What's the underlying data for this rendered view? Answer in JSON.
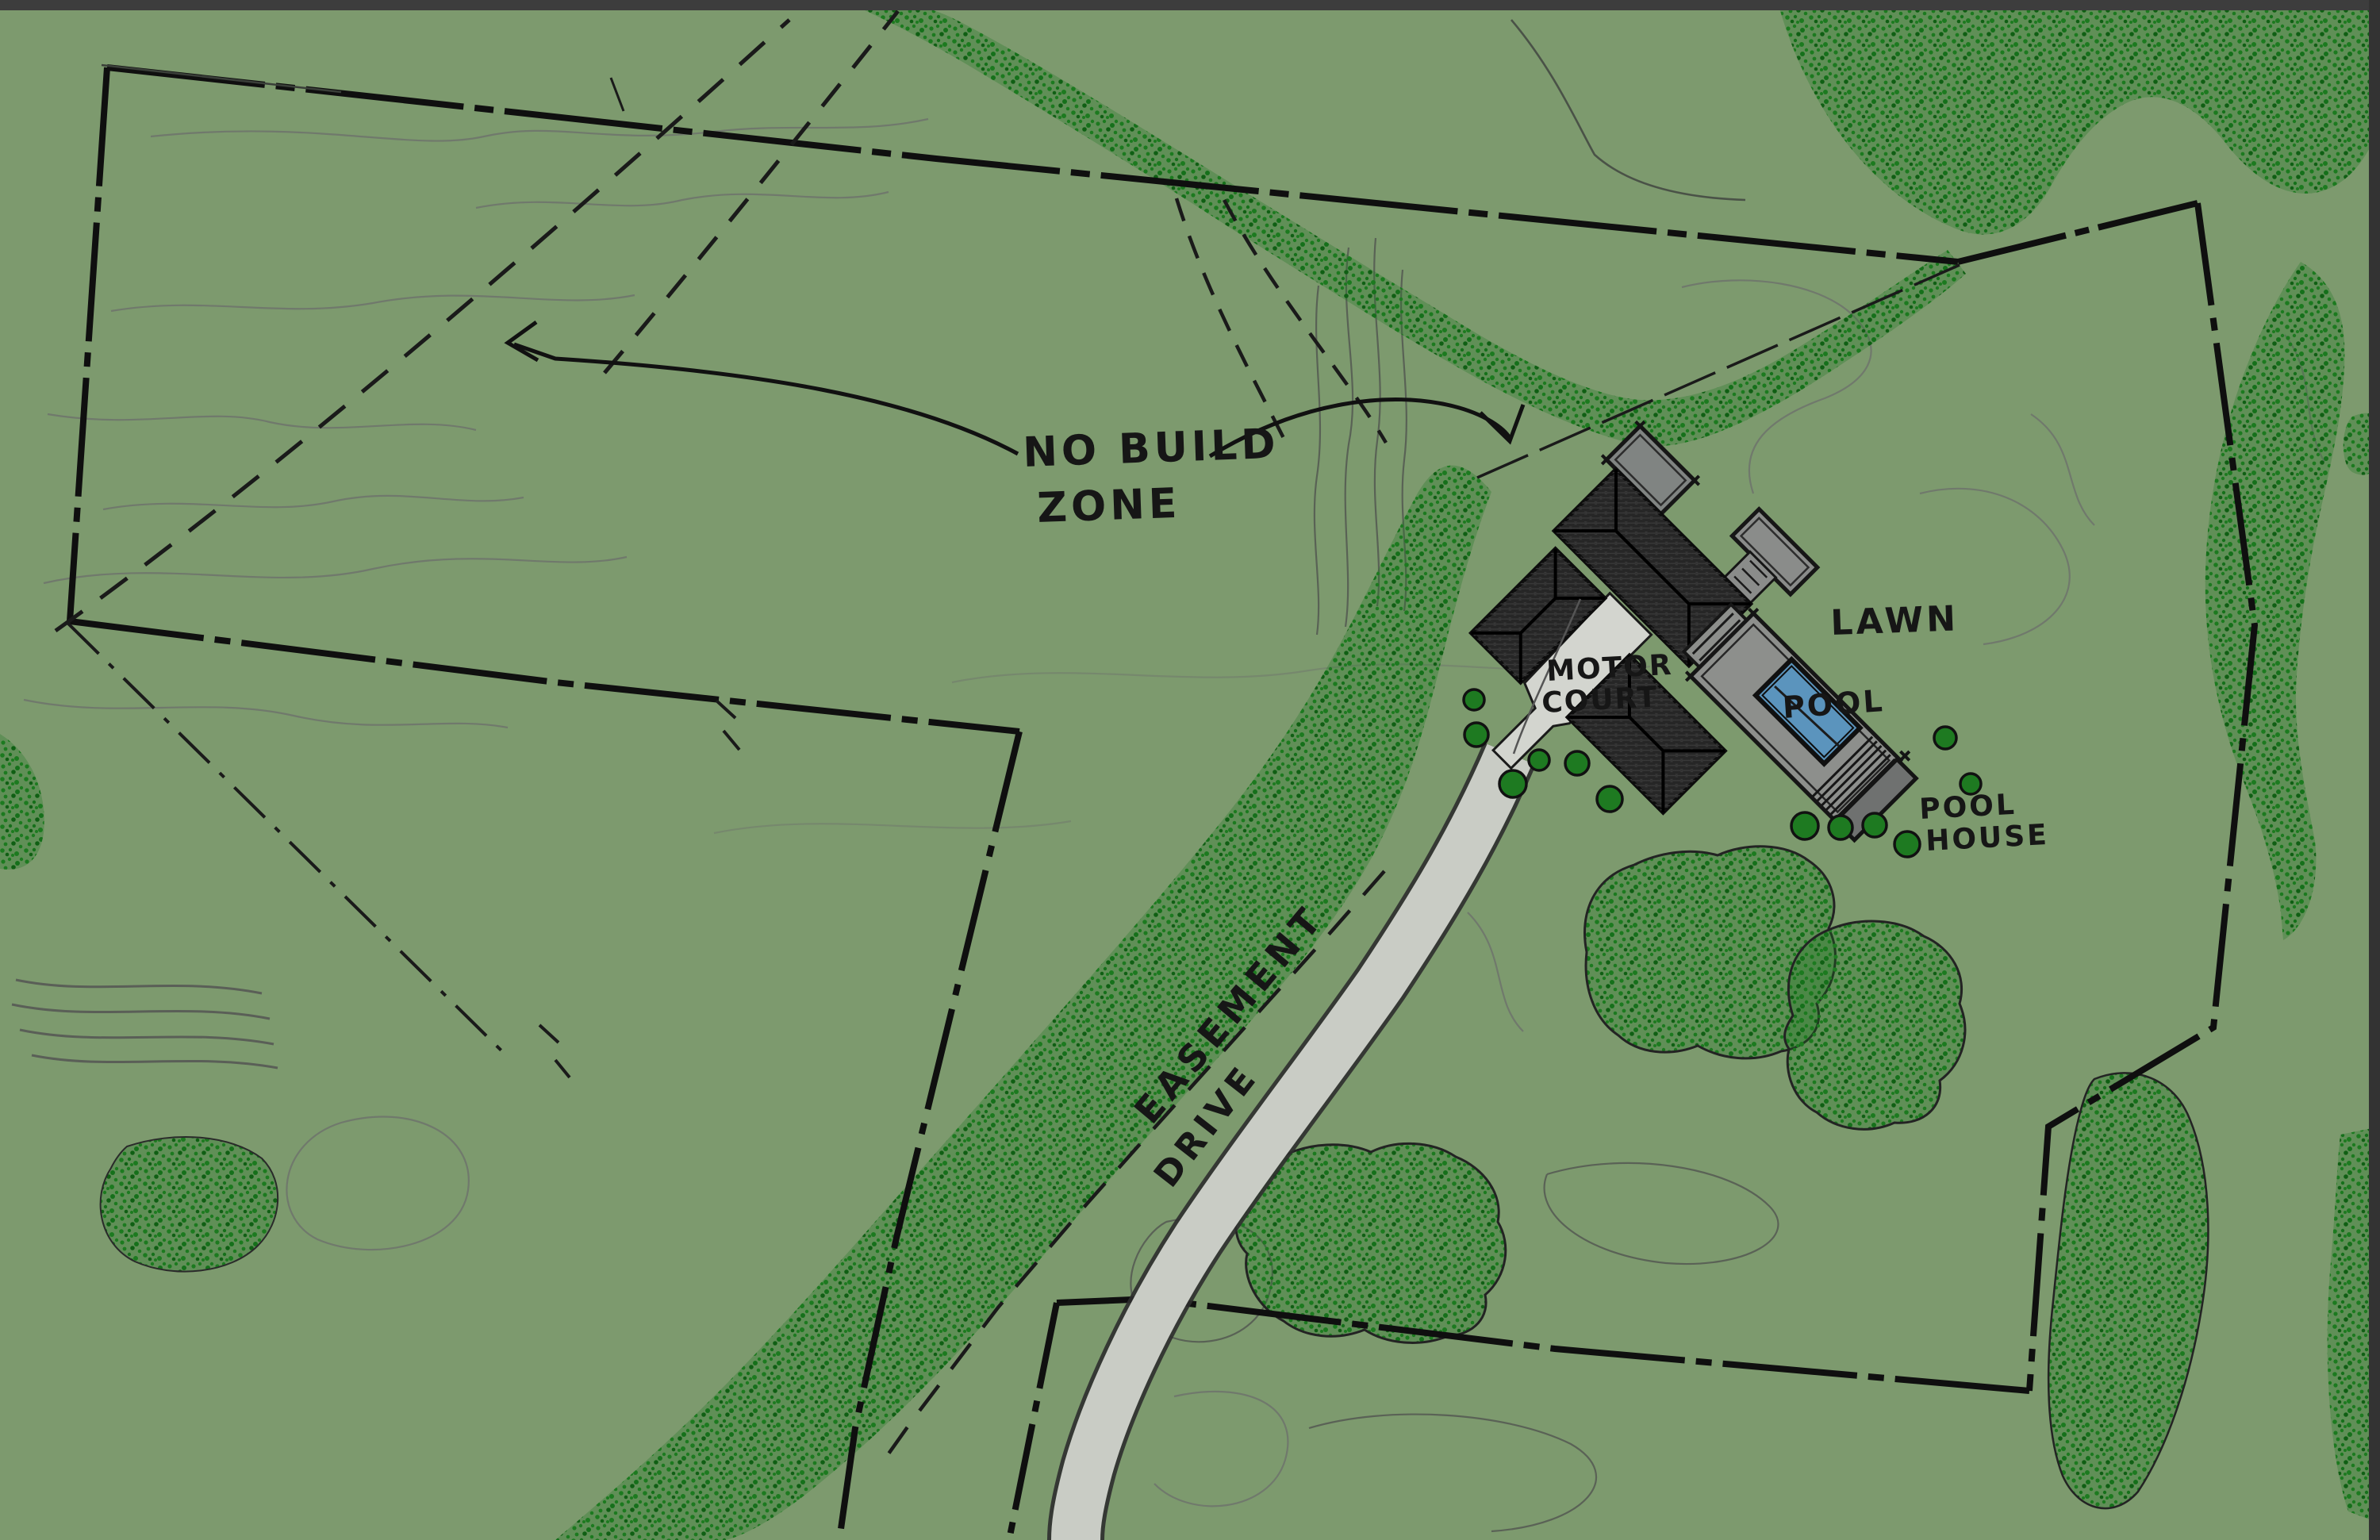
{
  "plan": {
    "type": "hand-drawn residential site plan sketch",
    "labels": {
      "no_build_line1": "NO BUILD",
      "no_build_line2": "ZONE",
      "motor_court_line1": "MOTOR",
      "motor_court_line2": "COURT",
      "lawn": "LAWN",
      "pool": "POOL",
      "pool_house_line1": "POOL",
      "pool_house_line2": "HOUSE",
      "easement": "EASEMENT",
      "drive": "DRIVE"
    },
    "colors": {
      "background": "#7d9a6e",
      "vegetation": "#1c7a1f",
      "vegetation_dark": "#0f5f13",
      "contour": "#6f766c",
      "ink": "#141414",
      "drive": "#c9ccc5",
      "motor_court": "#d3d5cf",
      "deck_gray": "#8d8f8c",
      "flat_roof_gray": "#808482",
      "dark_roof": "#262626",
      "pool_water": "#5b94bd",
      "edge_strip": "#3d3d3d"
    }
  }
}
